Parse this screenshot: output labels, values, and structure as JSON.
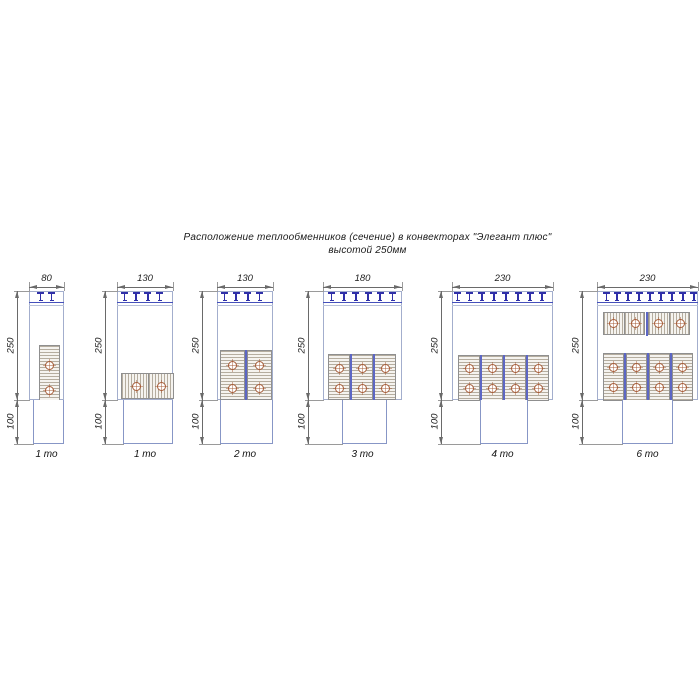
{
  "title": {
    "line1": "Расположение теплообменников (сечение) в конвекторах \"Элегант плюс\"",
    "line2": "высотой 250мм"
  },
  "colors": {
    "stroke": "#a3aecd",
    "strokeLight": "#b9c2da",
    "blue": "#4550bb",
    "blue2": "#5c66c4",
    "teeth": "#2f2fa8",
    "blockBorder": "#8f8f8f",
    "blockFill": "#f5f3ef",
    "hatch": "#b5ad9f",
    "tube": "#a65c38",
    "duct": "#8796c6",
    "dim": "#6a6a6a",
    "ext": "#9a9a9a"
  },
  "diagrams": [
    {
      "caption": "1 то",
      "width_label": "80",
      "height_label": "250",
      "plinth_label": "100",
      "body_x": 29,
      "body_w": 35,
      "dim_x": 17,
      "duct_x": 33,
      "duct_w": 31,
      "teeth_n": 2,
      "teeth_x0": 37,
      "teeth_step": 11,
      "blocks": [
        {
          "o": "v",
          "x": 39,
          "y": 345,
          "w": 21,
          "h": 56
        }
      ],
      "dividers": [],
      "tubes": [
        [
          49,
          365
        ],
        [
          49,
          390
        ]
      ]
    },
    {
      "caption": "1 то",
      "width_label": "130",
      "height_label": "250",
      "plinth_label": "100",
      "body_x": 117,
      "body_w": 56,
      "dim_x": 105,
      "duct_x": 123,
      "duct_w": 50,
      "teeth_n": 4,
      "teeth_x0": 121,
      "teeth_step": 11.7,
      "blocks": [
        {
          "o": "h",
          "x": 121,
          "y": 373,
          "w": 53,
          "h": 26
        }
      ],
      "dividers": [],
      "tubes": [
        [
          136,
          386
        ],
        [
          161,
          386
        ]
      ]
    },
    {
      "caption": "2 то",
      "width_label": "130",
      "height_label": "250",
      "plinth_label": "100",
      "body_x": 217,
      "body_w": 56,
      "dim_x": 202,
      "duct_x": 220,
      "duct_w": 53,
      "teeth_n": 4,
      "teeth_x0": 221,
      "teeth_step": 11.7,
      "blocks": [
        {
          "o": "v",
          "x": 220,
          "y": 350,
          "w": 25,
          "h": 50
        },
        {
          "o": "v",
          "x": 247,
          "y": 350,
          "w": 25,
          "h": 50
        }
      ],
      "dividers": [
        {
          "x": 245,
          "y": 350,
          "h": 53
        }
      ],
      "tubes": [
        [
          232,
          365
        ],
        [
          232,
          388
        ],
        [
          259,
          365
        ],
        [
          259,
          388
        ]
      ]
    },
    {
      "caption": "3 то",
      "width_label": "180",
      "height_label": "250",
      "plinth_label": "100",
      "body_x": 323,
      "body_w": 79,
      "dim_x": 308,
      "duct_x": 342,
      "duct_w": 45,
      "teeth_n": 6,
      "teeth_x0": 328,
      "teeth_step": 12.2,
      "blocks": [
        {
          "o": "v",
          "x": 328,
          "y": 354,
          "w": 22,
          "h": 46
        },
        {
          "o": "v",
          "x": 351,
          "y": 354,
          "w": 22,
          "h": 46
        },
        {
          "o": "v",
          "x": 374,
          "y": 354,
          "w": 22,
          "h": 46
        }
      ],
      "dividers": [
        {
          "x": 350,
          "y": 354,
          "h": 49
        },
        {
          "x": 373,
          "y": 354,
          "h": 49
        }
      ],
      "tubes": [
        [
          339,
          368
        ],
        [
          339,
          388
        ],
        [
          362,
          368
        ],
        [
          362,
          388
        ],
        [
          385,
          368
        ],
        [
          385,
          388
        ]
      ]
    },
    {
      "caption": "4 то",
      "width_label": "230",
      "height_label": "250",
      "plinth_label": "100",
      "body_x": 452,
      "body_w": 101,
      "dim_x": 441,
      "duct_x": 480,
      "duct_w": 48,
      "teeth_n": 8,
      "teeth_x0": 454,
      "teeth_step": 12.1,
      "blocks": [
        {
          "o": "v",
          "x": 458,
          "y": 355,
          "w": 22,
          "h": 46
        },
        {
          "o": "v",
          "x": 481,
          "y": 355,
          "w": 22,
          "h": 46
        },
        {
          "o": "v",
          "x": 504,
          "y": 355,
          "w": 22,
          "h": 46
        },
        {
          "o": "v",
          "x": 527,
          "y": 355,
          "w": 22,
          "h": 46
        }
      ],
      "dividers": [
        {
          "x": 480,
          "y": 355,
          "h": 49
        },
        {
          "x": 503,
          "y": 355,
          "h": 49
        },
        {
          "x": 526,
          "y": 355,
          "h": 49
        }
      ],
      "tubes": [
        [
          469,
          368
        ],
        [
          469,
          388
        ],
        [
          492,
          368
        ],
        [
          492,
          388
        ],
        [
          515,
          368
        ],
        [
          515,
          388
        ],
        [
          538,
          368
        ],
        [
          538,
          388
        ]
      ]
    },
    {
      "caption": "6 то",
      "width_label": "230",
      "height_label": "250",
      "plinth_label": "100",
      "body_x": 597,
      "body_w": 101,
      "dim_x": 582,
      "duct_x": 622,
      "duct_w": 51,
      "teeth_n": 9,
      "teeth_x0": 603,
      "teeth_step": 10.9,
      "blocks": [
        {
          "o": "h",
          "x": 603,
          "y": 312,
          "w": 42,
          "h": 23
        },
        {
          "o": "h",
          "x": 648,
          "y": 312,
          "w": 42,
          "h": 23
        },
        {
          "o": "v",
          "x": 603,
          "y": 353,
          "w": 21,
          "h": 48
        },
        {
          "o": "v",
          "x": 626,
          "y": 353,
          "w": 21,
          "h": 48
        },
        {
          "o": "v",
          "x": 649,
          "y": 353,
          "w": 21,
          "h": 48
        },
        {
          "o": "v",
          "x": 672,
          "y": 353,
          "w": 21,
          "h": 48
        }
      ],
      "dividers": [
        {
          "x": 646,
          "y": 312,
          "h": 24
        },
        {
          "x": 624,
          "y": 353,
          "h": 51
        },
        {
          "x": 647,
          "y": 353,
          "h": 51
        },
        {
          "x": 670,
          "y": 353,
          "h": 51
        }
      ],
      "tubes": [
        [
          613,
          323
        ],
        [
          635,
          323
        ],
        [
          658,
          323
        ],
        [
          680,
          323
        ],
        [
          613,
          367
        ],
        [
          613,
          387
        ],
        [
          636,
          367
        ],
        [
          636,
          387
        ],
        [
          659,
          367
        ],
        [
          659,
          387
        ],
        [
          682,
          367
        ],
        [
          682,
          387
        ]
      ]
    }
  ]
}
